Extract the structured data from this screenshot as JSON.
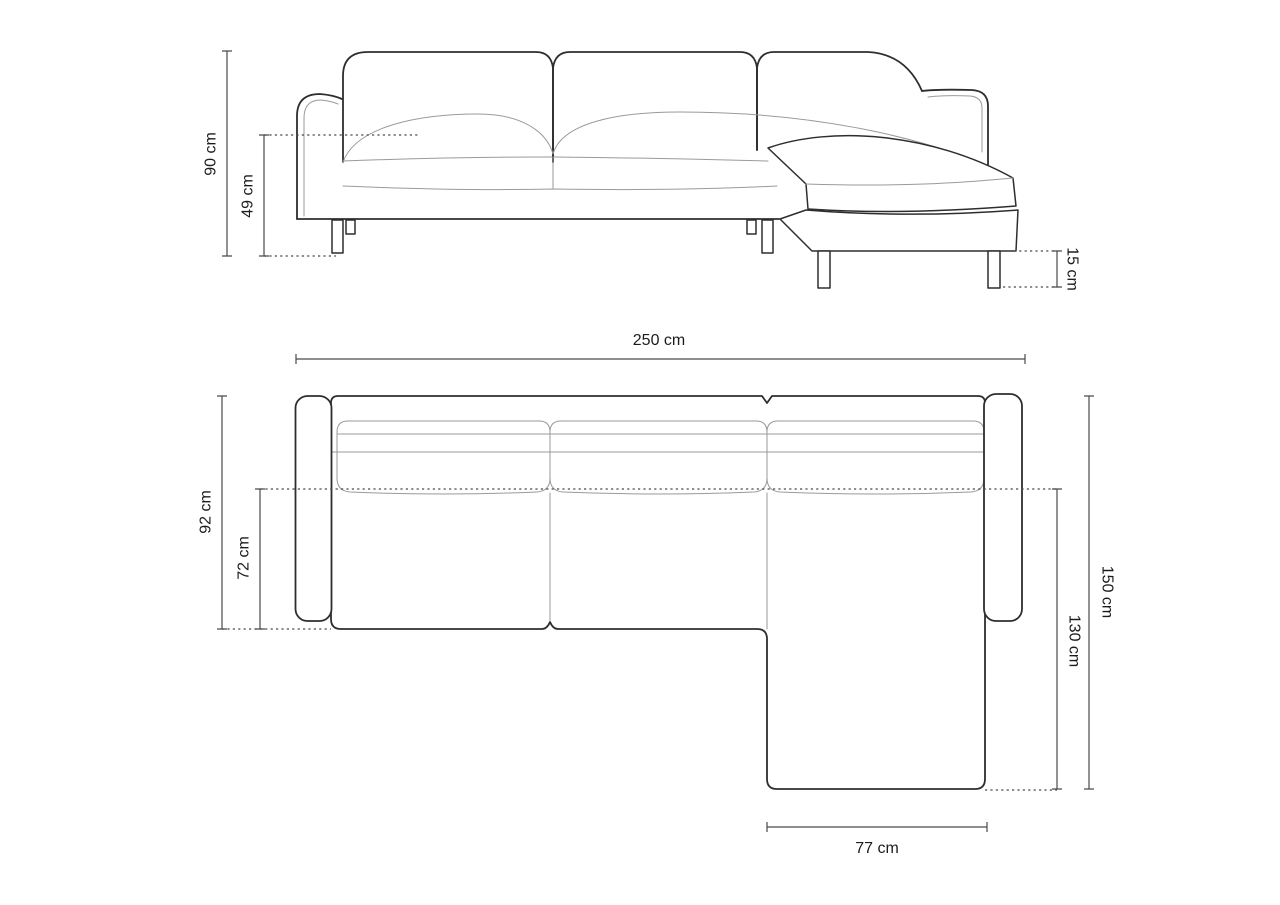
{
  "drawing": {
    "units": "cm",
    "front_view": {
      "overall_height_label": "90 cm",
      "seat_height_label": "49 cm",
      "leg_height_label": "15 cm"
    },
    "plan_view": {
      "overall_width_label": "250 cm",
      "overall_depth_label": "92 cm",
      "inner_seat_depth_label": "72 cm",
      "chaise_overall_depth_label": "150 cm",
      "chaise_extension_depth_label": "130 cm",
      "chaise_width_label": "77 cm"
    }
  },
  "colors": {
    "outline": "#2e2e2e",
    "detail": "#9a9a9a",
    "dimension": "#4a4a4a",
    "text": "#1c1c1c",
    "background": "#ffffff"
  }
}
